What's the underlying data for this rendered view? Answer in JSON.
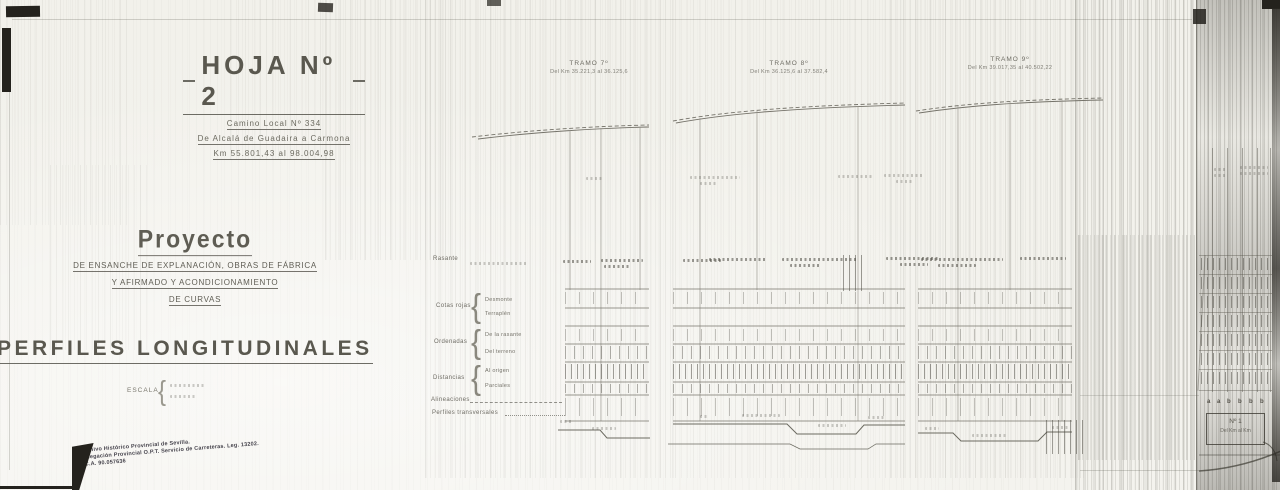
{
  "sheet": {
    "title": "HOJA Nº 2",
    "road": "Camino Local Nº 334",
    "road_stretch": "De Alcalá de Guadaira a Carmona",
    "road_km": "Km 55.801,43 al 98.004,98",
    "project_heading": "Proyecto",
    "project_line1": "DE ENSANCHE DE EXPLANACIÓN, OBRAS DE FÁBRICA",
    "project_line2": "Y AFIRMADO Y ACONDICIONAMIENTO",
    "project_line3": "DE CURVAS",
    "drawing_title": "PERFILES LONGITUDINALES",
    "scale_label": "ESCALA"
  },
  "tramos": [
    {
      "name": "TRAMO 7º",
      "range": "Del Km 35.221,3 al 36.125,6"
    },
    {
      "name": "TRAMO 8º",
      "range": "Del Km 36.125,6 al 37.582,4"
    },
    {
      "name": "TRAMO 9º",
      "range": "Del Km 39.017,35 al 40.502,22"
    }
  ],
  "guitar": {
    "rasante": "Rasante",
    "cotas_rojas_label": "Cotas rojas",
    "cotas_rojas_1": "Desmonte",
    "cotas_rojas_2": "Terraplén",
    "ordenadas_label": "Ordenadas",
    "ordenadas_1": "De la rasante",
    "ordenadas_2": "Del terreno",
    "distancias_label": "Distancias",
    "distancias_1": "Al origen",
    "distancias_2": "Parciales",
    "alineaciones": "Alineaciones",
    "perfiles_transversales": "Perfiles transversales"
  },
  "stamp": {
    "line1": "Archivo Histórico Provincial de Sevilla.",
    "line2": "Delegación Provincial O.P.T. Servicio de Carreteras. Leg. 13202.",
    "line3": "I.C.A. 90.057636"
  },
  "margin_table": {
    "letters": [
      "a",
      "a",
      "b",
      "b",
      "b",
      "b"
    ],
    "box_no": "Nº 1",
    "box_range": "Del Km al Km"
  }
}
